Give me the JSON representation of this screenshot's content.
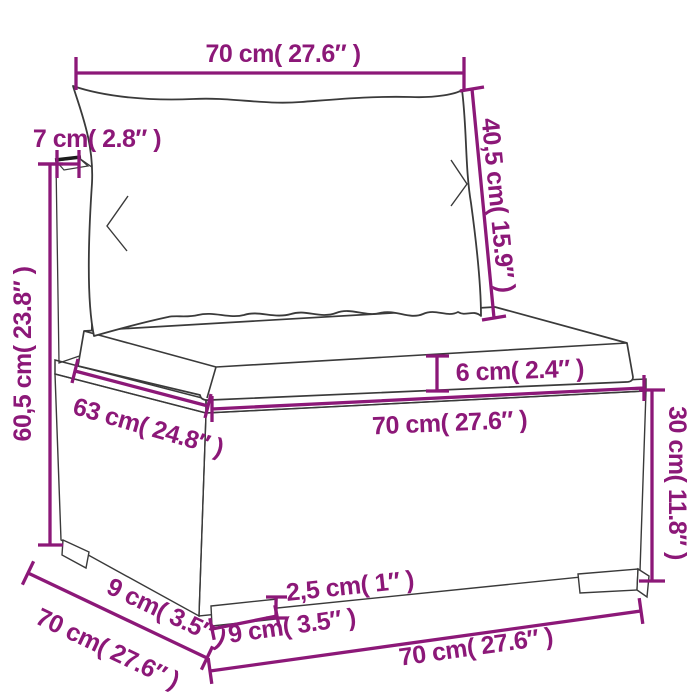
{
  "diagram": {
    "subject": "poly-rattan-sofa-section-with-cushions",
    "colors": {
      "dimension_accent": "#8C1878",
      "artwork_outline": "#3A3A3A",
      "background": "#FFFFFF"
    },
    "labels": {
      "top_width": "70 cm( 27.6″ )",
      "back_thickness": "7 cm( 2.8″ )",
      "back_cushion_height": "40,5 cm( 15.9″ )",
      "total_height": "60,5 cm( 23.8″ )",
      "cushion_thickness": "6 cm( 2.4″ )",
      "seat_edge_depth": "63 cm( 24.8″ )",
      "seat_front_width": "70 cm( 27.6″ )",
      "base_height": "30 cm( 11.8″ )",
      "side_leg_depth": "9 cm( 3.5″ )",
      "side_depth": "70 cm( 27.6″ )",
      "leg_height": "2,5 cm( 1″ )",
      "front_leg_width": "9 cm( 3.5″ )",
      "bottom_front_width": "70 cm( 27.6″ )"
    }
  }
}
